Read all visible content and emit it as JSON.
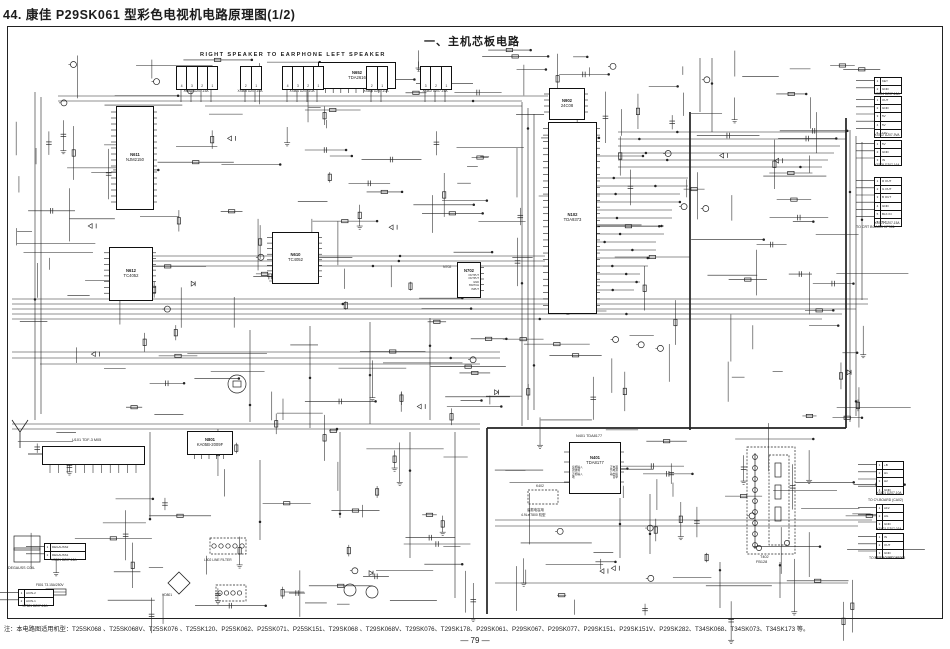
{
  "page": {
    "title": "44. 康佳 P29SK061 型彩色电视机电路原理图(1/2)",
    "section_label": "一、主机芯板电路",
    "footnote": "注：本电路图适用机型：T25SK068 、T25SK068V、T25SK076 、T25SK120、P25SK062、P25SK071、P25SK151、T29SK068 、T29SK068V、T29SK076、T29SK178、P29SK061、P29SK067、P29SK077、P29SK151、P29SK151V、P29SK282、T34SK068、T34SK073、T34SK173 等。",
    "page_number": "— 79 —"
  },
  "colors": {
    "ink": "#222222",
    "paper": "#ffffff"
  },
  "schematic": {
    "ics": [
      {
        "ref": "N611",
        "part": "NJM2150",
        "x": 116,
        "y": 106,
        "w": 36,
        "h": 102,
        "pl": 16,
        "pr": 16
      },
      {
        "ref": "N652",
        "part": "TDA2616",
        "x": 318,
        "y": 62,
        "w": 76,
        "h": 25,
        "pb": 9
      },
      {
        "ref": "N902",
        "part": "24C08",
        "x": 549,
        "y": 88,
        "w": 34,
        "h": 30,
        "pl": 4,
        "pr": 4
      },
      {
        "ref": "N102",
        "part": "TDA9373",
        "x": 548,
        "y": 122,
        "w": 47,
        "h": 190,
        "pl": 28,
        "pr": 28
      },
      {
        "ref": "N612",
        "part": "TC4052",
        "x": 109,
        "y": 247,
        "w": 42,
        "h": 52,
        "pl": 8,
        "pr": 8
      },
      {
        "ref": "N610",
        "part": "TC4052",
        "x": 272,
        "y": 232,
        "w": 45,
        "h": 50,
        "pl": 8,
        "pr": 8
      },
      {
        "ref": "N401",
        "part": "TDA8177",
        "x": 569,
        "y": 442,
        "w": 50,
        "h": 50,
        "pl": 4,
        "pr": 4,
        "pairs": [
          [
            "反相输入",
            "正电源"
          ],
          [
            "滤波端",
            "负电源"
          ],
          [
            "正相输入",
            "输出级"
          ],
          [
            "地",
            "自举"
          ]
        ]
      },
      {
        "ref": "N801",
        "part": "KA05B-2009F",
        "x": 187,
        "y": 431,
        "w": 44,
        "h": 22,
        "pb": 5
      },
      {
        "ref": "N702",
        "part": "",
        "x": 457,
        "y": 262,
        "w": 22,
        "h": 34,
        "pr": 5,
        "rows": [
          "OUTPUT",
          "OUTPUT",
          "GND",
          "SWITCH",
          "INPUT"
        ]
      }
    ],
    "tuner": {
      "ref": "U101",
      "part": "TDF-3 M05",
      "x": 42,
      "y": 446,
      "w": 101,
      "h": 17,
      "pins": 11
    },
    "flyback": {
      "ref": "T402",
      "part": "FB128",
      "x": 747,
      "y": 447,
      "w": 48,
      "h": 107
    },
    "connectors_top": [
      {
        "x": 176,
        "y": 66,
        "cells": 4,
        "caption": "XS603",
        "caption2": "DZ07-15A"
      },
      {
        "x": 240,
        "y": 66,
        "cells": 2,
        "caption": "XS605",
        "caption2": "DZ07-10A"
      },
      {
        "x": 282,
        "y": 66,
        "cells": 4,
        "caption": "XS601",
        "caption2": "DZ07-10A"
      },
      {
        "x": 366,
        "y": 66,
        "cells": 2,
        "caption": "XS606",
        "caption2": "DZ07-10A"
      },
      {
        "x": 420,
        "y": 66,
        "cells": 3,
        "caption": "XS602",
        "caption2": "DZ07-16A"
      }
    ],
    "connectors_right": [
      {
        "x": 874,
        "y": 77,
        "rows": [
          "KEY",
          "GND"
        ],
        "caption": "XS904 DZ07-10A"
      },
      {
        "x": 874,
        "y": 96,
        "rows": [
          "OUT",
          "GND",
          "5V",
          "5V",
          "12V"
        ],
        "caption": "XS902 DZ07-9VA"
      },
      {
        "x": 874,
        "y": 140,
        "rows": [
          "5V",
          "GND",
          "IN"
        ],
        "caption": "XS905 DZ07-16A"
      },
      {
        "x": 874,
        "y": 177,
        "rows": [
          "R OUT",
          "G OUT",
          "B OUT",
          "GND",
          "BLK IN",
          "5V"
        ],
        "caption": "XS901 DZ07-15A"
      },
      {
        "x": 876,
        "y": 461,
        "rows": [
          "+B",
          "H1",
          "H2",
          "GND"
        ],
        "caption": "XS401 DZ07-10A"
      },
      {
        "x": 876,
        "y": 504,
        "rows": [
          "AF2",
          "AG",
          "GND"
        ],
        "caption": "XS403 DZ07-03A"
      },
      {
        "x": 876,
        "y": 533,
        "rows": [
          "IN",
          "OUT",
          "GND"
        ],
        "caption": "XS405 DZ07-04A-14"
      }
    ],
    "connectors_left_bottom": [
      {
        "x": 44,
        "y": 543,
        "w": 40,
        "rows": [
          "DEGAUSS2",
          "DEGAUSS1"
        ],
        "caption": "XS801 DZ07-12A"
      },
      {
        "x": 18,
        "y": 589,
        "w": 34,
        "rows": [
          "ACIN-2",
          "ACIN-1"
        ],
        "caption": "XP801 DZ07-12A"
      }
    ],
    "labels": [
      {
        "t": "RIGHT SPEAKER TO EARPHONE LEFT SPEAKER",
        "x": 200,
        "y": 53,
        "s": 5.6,
        "b": 1,
        "ls": 1.4
      },
      {
        "t": "U101 TDF-3 M05",
        "x": 72,
        "y": 439,
        "s": 3.8,
        "b": 0
      },
      {
        "t": "N401 TDA8177",
        "x": 576,
        "y": 435,
        "s": 3.8,
        "b": 0
      },
      {
        "t": "T402",
        "x": 760,
        "y": 556,
        "s": 3.8,
        "b": 0
      },
      {
        "t": "FB128",
        "x": 756,
        "y": 561,
        "s": 3.8,
        "b": 0
      },
      {
        "t": "DEGAUSS COIL",
        "x": 8,
        "y": 567,
        "s": 3.6,
        "b": 0
      },
      {
        "t": "F801 T3.15A/250V",
        "x": 36,
        "y": 584,
        "s": 3.3,
        "b": 0
      },
      {
        "t": "VD801",
        "x": 162,
        "y": 594,
        "s": 3.3,
        "b": 0
      },
      {
        "t": "L802 LINE FILTER",
        "x": 204,
        "y": 559,
        "s": 3.3,
        "b": 0
      },
      {
        "t": "N702",
        "x": 443,
        "y": 266,
        "s": 3.5,
        "b": 0
      },
      {
        "t": "K402",
        "x": 536,
        "y": 485,
        "s": 3.4,
        "b": 0
      },
      {
        "t": "谐振电容用",
        "x": 527,
        "y": 509,
        "s": 3.4,
        "b": 0
      },
      {
        "t": "4.9Lx/7800 机型",
        "x": 521,
        "y": 514,
        "s": 3.4,
        "b": 0
      },
      {
        "t": "TO CRT BOARD XP901",
        "x": 856,
        "y": 226,
        "s": 3.6,
        "b": 0
      },
      {
        "t": "TO CY-BOARD (CA02)",
        "x": 868,
        "y": 499,
        "s": 3.4,
        "b": 0
      },
      {
        "t": "TO SET BOARD XP905",
        "x": 869,
        "y": 557,
        "s": 3.4,
        "b": 0
      }
    ]
  }
}
